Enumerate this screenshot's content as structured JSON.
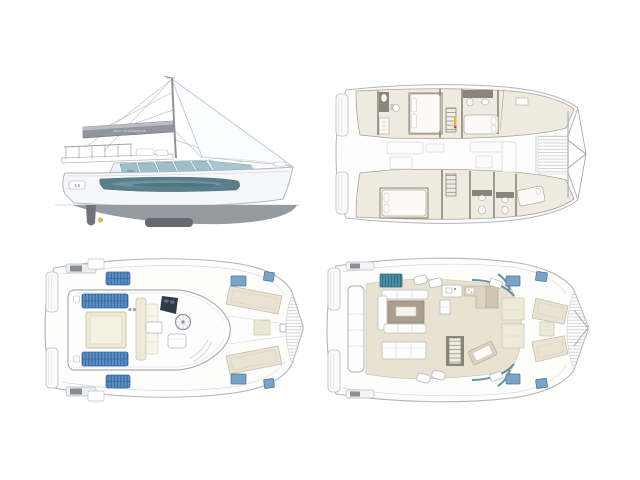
{
  "canvas": {
    "width": 640,
    "height": 480,
    "background": "#ffffff"
  },
  "branding": {
    "boom_text": "BALI CATAMARANS",
    "windshield_text": "BALI",
    "stern_badge": "4.6",
    "bow_text": "BALI"
  },
  "views": [
    {
      "id": "side-profile",
      "name": "sailing-profile-view"
    },
    {
      "id": "accommodation-plan",
      "name": "hull-accommodation-plan-view"
    },
    {
      "id": "flybridge-deck-plan",
      "name": "flybridge-deck-plan-view"
    },
    {
      "id": "main-deck-plan",
      "name": "main-deck-saloon-plan-view"
    }
  ],
  "colors": {
    "outline": "#b0b6bb",
    "outline_faint": "#d4d8db",
    "wall": "#8b8478",
    "floor_beige": "#f0ebe1",
    "floor_cockpit": "#e9e2d3",
    "cream_pad": "#efe9d8",
    "lounge_beige": "#eae3d2",
    "taupe_table": "#a89f8e",
    "counter_beige": "#ddd5c3",
    "pad_blue": "#5b8fc6",
    "pad_blue_dark": "#37659f",
    "hatch_blue": "#7ba3c4",
    "hatch_blue_dark": "#44759c",
    "glass_teal": "#9dbfc9",
    "glass_teal_dark": "#4e8296",
    "teal_module": "#4b8ea6",
    "hull_window": "#5a7f8b",
    "boom_gray": "#90969c",
    "underwater": "#949ba1",
    "keel": "#646b72",
    "console_dark": "#2e3a46",
    "accent_yellow": "#e3b93c",
    "accent_red": "#c43b2e"
  }
}
